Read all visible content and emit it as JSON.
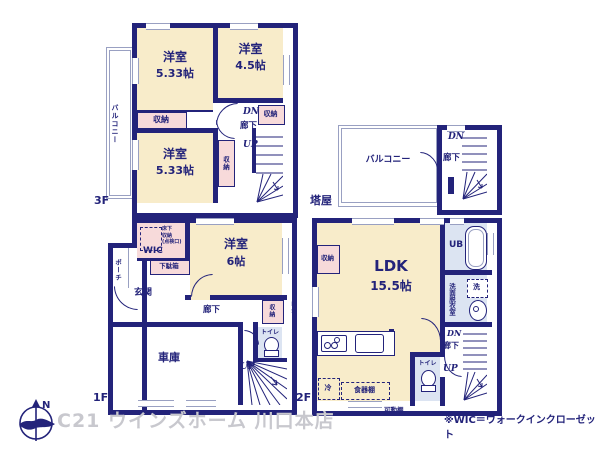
{
  "colors": {
    "wall": "#23237a",
    "room_cream": "#f8ecca",
    "closet_pink": "#f7dada",
    "bath_blue": "#dce4f2",
    "thin_line": "#99a0c2",
    "watermark_gray": "#c8c8ce"
  },
  "floor3": {
    "label": "3F",
    "bedroom_a_name": "洋室",
    "bedroom_a_size": "5.33帖",
    "bedroom_b_name": "洋室",
    "bedroom_b_size": "4.5帖",
    "bedroom_c_name": "洋室",
    "bedroom_c_size": "5.33帖",
    "balcony": "バルコニー",
    "closet_a": "収納",
    "closet_b": "収納",
    "closet_c": "収納",
    "dn": "DN",
    "hallway": "廊下",
    "up": "UP"
  },
  "tower": {
    "label": "塔屋",
    "balcony": "バルコニー",
    "dn": "DN",
    "hallway": "廊下"
  },
  "floor1": {
    "label": "1F",
    "bedroom_name": "洋室",
    "bedroom_size": "6帖",
    "wic": "WIC",
    "underfloor_storage": [
      "床下",
      "収納",
      "(点検口)"
    ],
    "shoe_cabinet": "下駄箱",
    "porch": "ポーチ",
    "entrance": "玄関",
    "hallway": "廊下",
    "closet": "収納",
    "pipe_space": "PS",
    "toilet": "トイレ",
    "garage": "車庫",
    "up": "UP"
  },
  "floor2": {
    "label": "2F",
    "ldk_name": "LDK",
    "ldk_size": "15.5帖",
    "closet": "収納",
    "unit_bath": "UB",
    "washroom": "洗面脱衣室",
    "laundry": "洗",
    "toilet": "トイレ",
    "refrigerator": "冷",
    "cupboard": "食器棚",
    "movable_shelf": "可動棚",
    "dn": "DN",
    "hallway": "廊下",
    "up": "UP"
  },
  "footer": {
    "compass_north": "N",
    "watermark": "C21 ウインズホーム 川口本店",
    "note": "※WIC＝ウォークインクローゼット"
  }
}
